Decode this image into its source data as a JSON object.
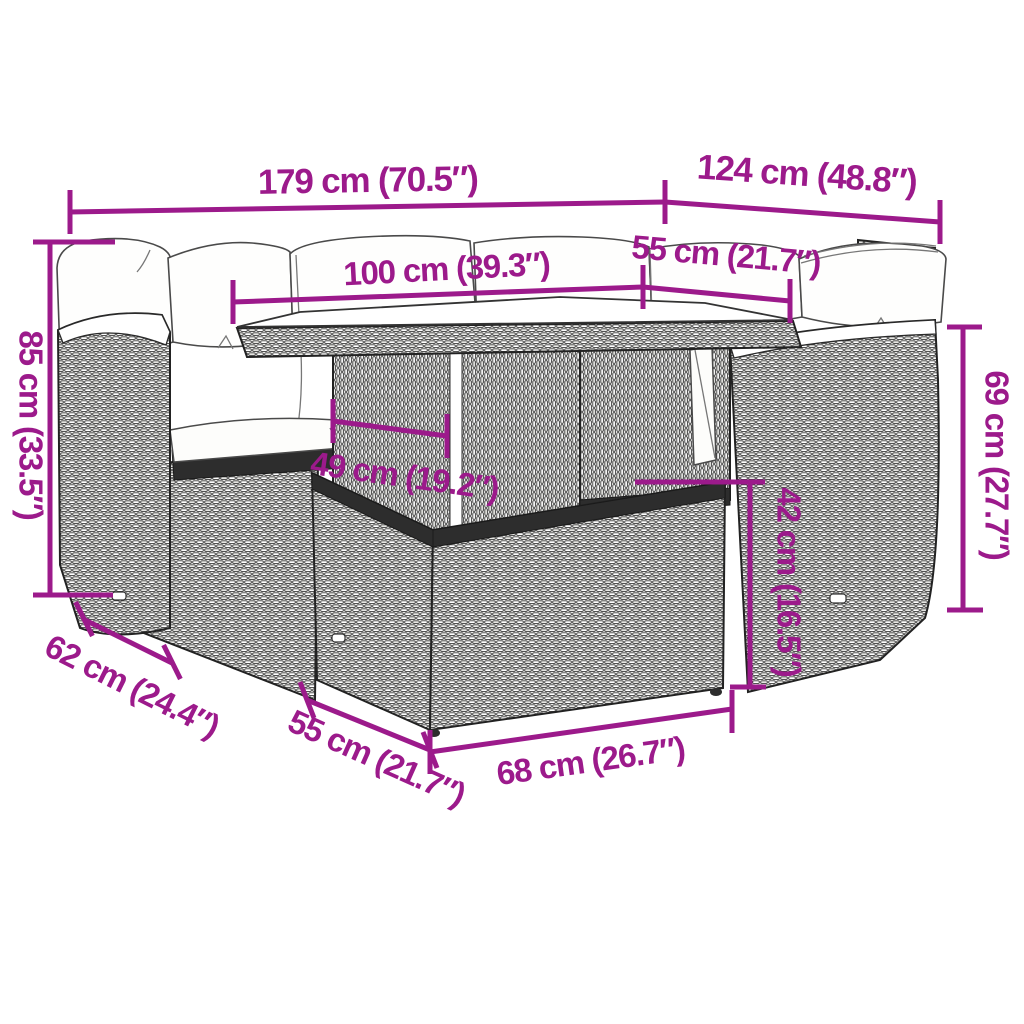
{
  "diagram": {
    "title": "5-piece poly rattan garden lounge set — dimension drawing",
    "accent_color": "#9C1A8B",
    "line_art_color": "#2d2d2d",
    "dims": {
      "total_width": "179 cm (70.5″)",
      "side_depth_top": "124 cm (48.8″)",
      "left_section_width": "100 cm (39.3″)",
      "right_section_width": "55 cm (21.7″)",
      "back_height": "85 cm (33.5″)",
      "table_width": "49 cm (19.2″)",
      "right_back_height": "69 cm (27.7″)",
      "seat_height": "42 cm (16.5″)",
      "sofa_depth": "62 cm (24.4″)",
      "stool_depth": "55 cm (21.7″)",
      "stool_width": "68 cm (26.7″)"
    }
  }
}
